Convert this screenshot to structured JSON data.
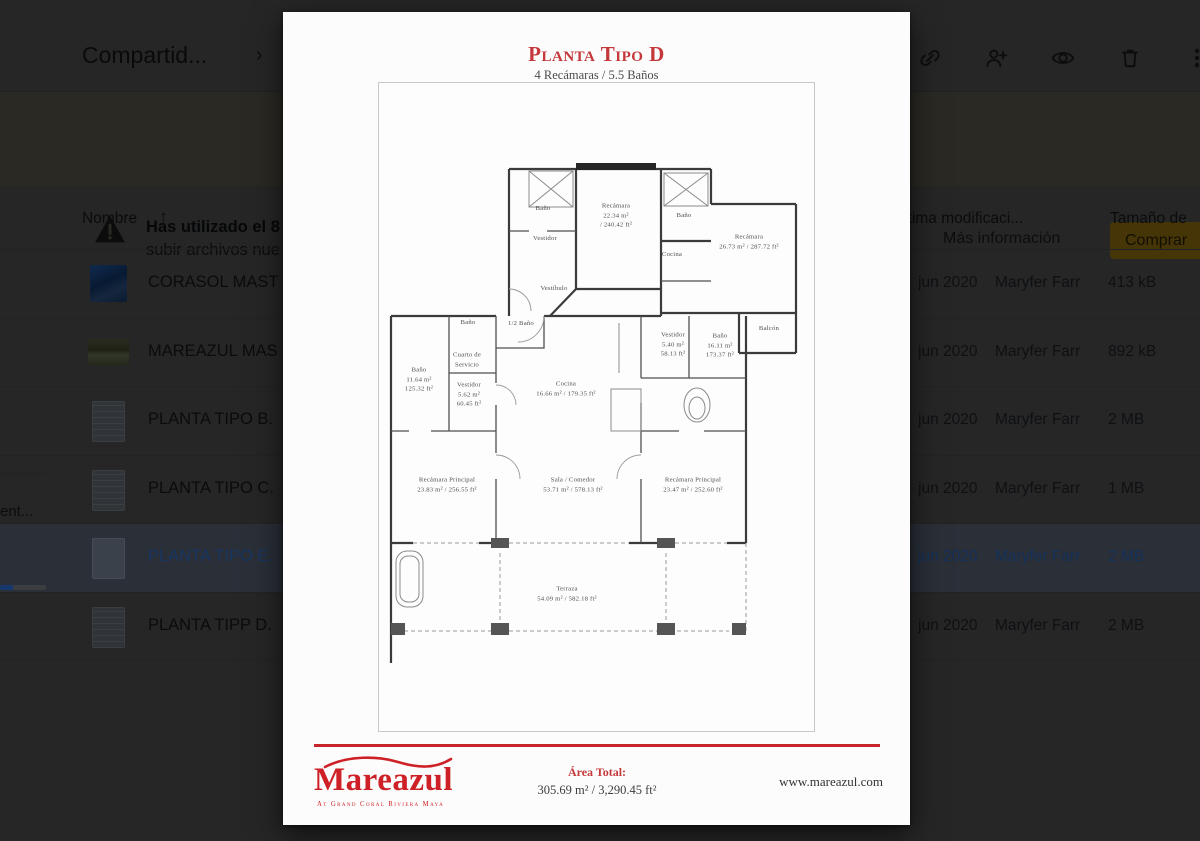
{
  "drive": {
    "header": {
      "title": "Compartid...",
      "chevron": "›"
    },
    "toolbar": {
      "icons": [
        "link-icon",
        "person-add-icon",
        "preview-icon",
        "trash-icon",
        "more-icon"
      ]
    },
    "banner": {
      "text_line1": "Has utilizado el 8",
      "text_line2": "subir archivos nue",
      "more_info_label": "Más información",
      "buy_label": "Comprar"
    },
    "storage": {
      "label": "ent..."
    },
    "table": {
      "name_header": "Nombre",
      "sort_arrow": "↑",
      "modified_header": "Última modificaci...",
      "size_header": "Tamaño de"
    },
    "rows": [
      {
        "name": "CORASOL MAST",
        "modified": "jun 2020",
        "owner": "Maryfer Farr",
        "size": "413 kB",
        "selected": false
      },
      {
        "name": "MAREAZUL MAS",
        "modified": "jun 2020",
        "owner": "Maryfer Farr",
        "size": "892 kB",
        "selected": false
      },
      {
        "name": "PLANTA TIPO B.",
        "modified": "jun 2020",
        "owner": "Maryfer Farr",
        "size": "2 MB",
        "selected": false
      },
      {
        "name": "PLANTA TIPO C.",
        "modified": "jun 2020",
        "owner": "Maryfer Farr",
        "size": "1 MB",
        "selected": false
      },
      {
        "name": "PLANTA TIPO E.",
        "modified": "jun 2020",
        "owner": "Maryfer Farr",
        "size": "2 MB",
        "selected": true
      },
      {
        "name": "PLANTA TIPP D.",
        "modified": "jun 2020",
        "owner": "Maryfer Farr",
        "size": "2 MB",
        "selected": false
      }
    ]
  },
  "preview": {
    "title": "Planta Tipo D",
    "subtitle": "4 Recámaras / 5.5 Baños",
    "accent_red": "#c6262b",
    "rooms": [
      {
        "id": "bano-noroeste",
        "text": "Baño"
      },
      {
        "id": "vestidor-norte",
        "text": "Vestidor"
      },
      {
        "id": "recamara-norte",
        "text": "Recámara\n22.34 m²\n/ 240.42 ft²"
      },
      {
        "id": "bano-noreste",
        "text": "Baño"
      },
      {
        "id": "cocina-nook",
        "text": "Cocina"
      },
      {
        "id": "recamara-este",
        "text": "Recámara\n26.73 m² / 287.72 ft²"
      },
      {
        "id": "vestibulo",
        "text": "Vestíbulo"
      },
      {
        "id": "medio-bano",
        "text": "1/2 Baño"
      },
      {
        "id": "balcon",
        "text": "Balcón"
      },
      {
        "id": "bano-servicio",
        "text": "Baño"
      },
      {
        "id": "cuarto-servicio",
        "text": "Cuarto de\nServicio"
      },
      {
        "id": "bano-izquierdo",
        "text": "Baño\n11.64 m²\n125.32 ft²"
      },
      {
        "id": "vestidor-izquierdo",
        "text": "Vestidor\n5.62 m²\n60.45 ft²"
      },
      {
        "id": "cocina",
        "text": "Cocina\n16.66 m² / 179.35 ft²"
      },
      {
        "id": "vestidor-derecho",
        "text": "Vestidor\n5.40 m²\n58.13 ft²"
      },
      {
        "id": "bano-derecho",
        "text": "Baño\n16.11 m²\n173.37 ft²"
      },
      {
        "id": "recamara-principal-izquierda",
        "text": "Recámara Principal\n23.83 m² / 256.55 ft²"
      },
      {
        "id": "sala-comedor",
        "text": "Sala / Comedor\n53.71 m² / 578.13 ft²"
      },
      {
        "id": "recamara-principal-derecha",
        "text": "Recámara Principal\n23.47 m² / 252.60 ft²"
      },
      {
        "id": "terraza",
        "text": "Terraza\n54.09 m² / 582.18 ft²"
      }
    ],
    "footer": {
      "logo_text": "Mareazul",
      "logo_subtext": "At Grand Coral Riviera Maya",
      "area_label": "Área Total:",
      "area_value": "305.69 m² / 3,290.45 ft²",
      "website": "www.mareazul.com"
    }
  }
}
